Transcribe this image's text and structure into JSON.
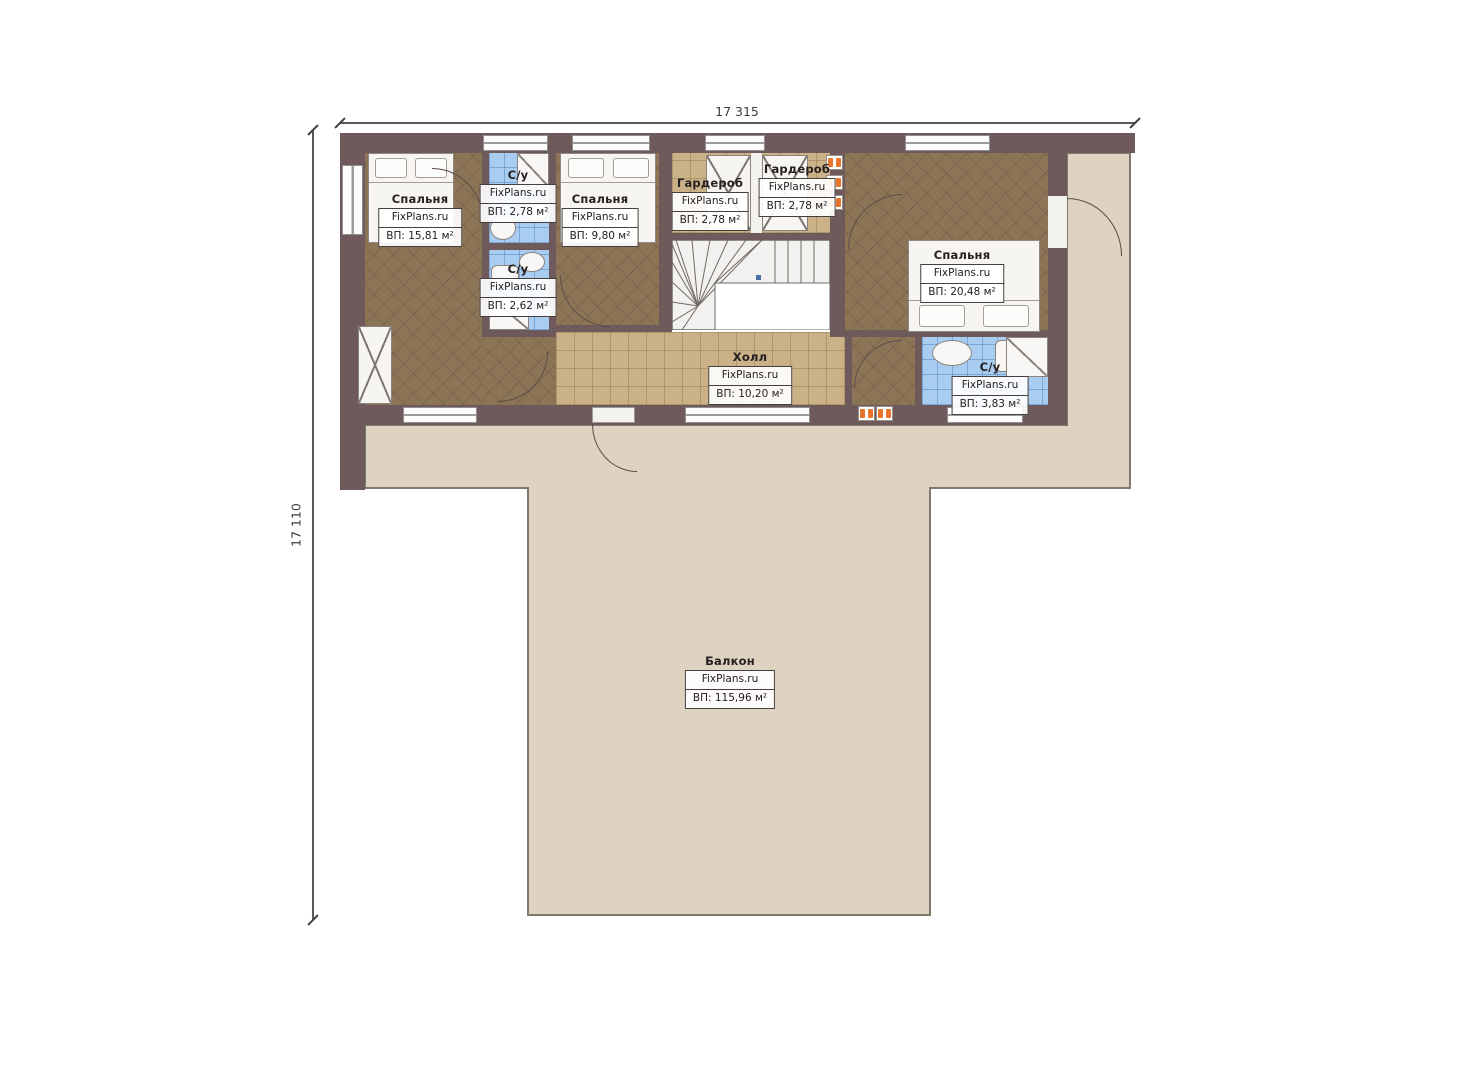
{
  "watermark": "FixPlans.ru",
  "dimensions": {
    "width_label": "17 315",
    "height_label": "17 110"
  },
  "rooms": [
    {
      "id": "bedroom-1",
      "name": "Спальня",
      "area": "ВП: 15,81 м²"
    },
    {
      "id": "bathroom-1",
      "name": "С/у",
      "area": "ВП: 2,78 м²"
    },
    {
      "id": "bedroom-2",
      "name": "Спальня",
      "area": "ВП: 9,80 м²"
    },
    {
      "id": "wardrobe-1",
      "name": "Гардероб",
      "area": "ВП: 2,78 м²"
    },
    {
      "id": "wardrobe-2",
      "name": "Гардероб",
      "area": "ВП: 2,78 м²"
    },
    {
      "id": "bathroom-2",
      "name": "С/у",
      "area": "ВП: 2,62 м²"
    },
    {
      "id": "bedroom-3",
      "name": "Спальня",
      "area": "ВП: 20,48 м²"
    },
    {
      "id": "bathroom-3",
      "name": "С/у",
      "area": "ВП: 3,83 м²"
    },
    {
      "id": "hall",
      "name": "Холл",
      "area": "ВП: 10,20 м²"
    },
    {
      "id": "balcony",
      "name": "Балкон",
      "area": "ВП: 115,96 м²"
    }
  ],
  "colors": {
    "wall": "#6e5a5a",
    "bedroom_floor": "#8c7456",
    "corridor_floor": "#cbb187",
    "bathroom_floor": "#a9cdf0",
    "balcony_floor": "#ded2c0",
    "radiator": "#e8732a"
  }
}
